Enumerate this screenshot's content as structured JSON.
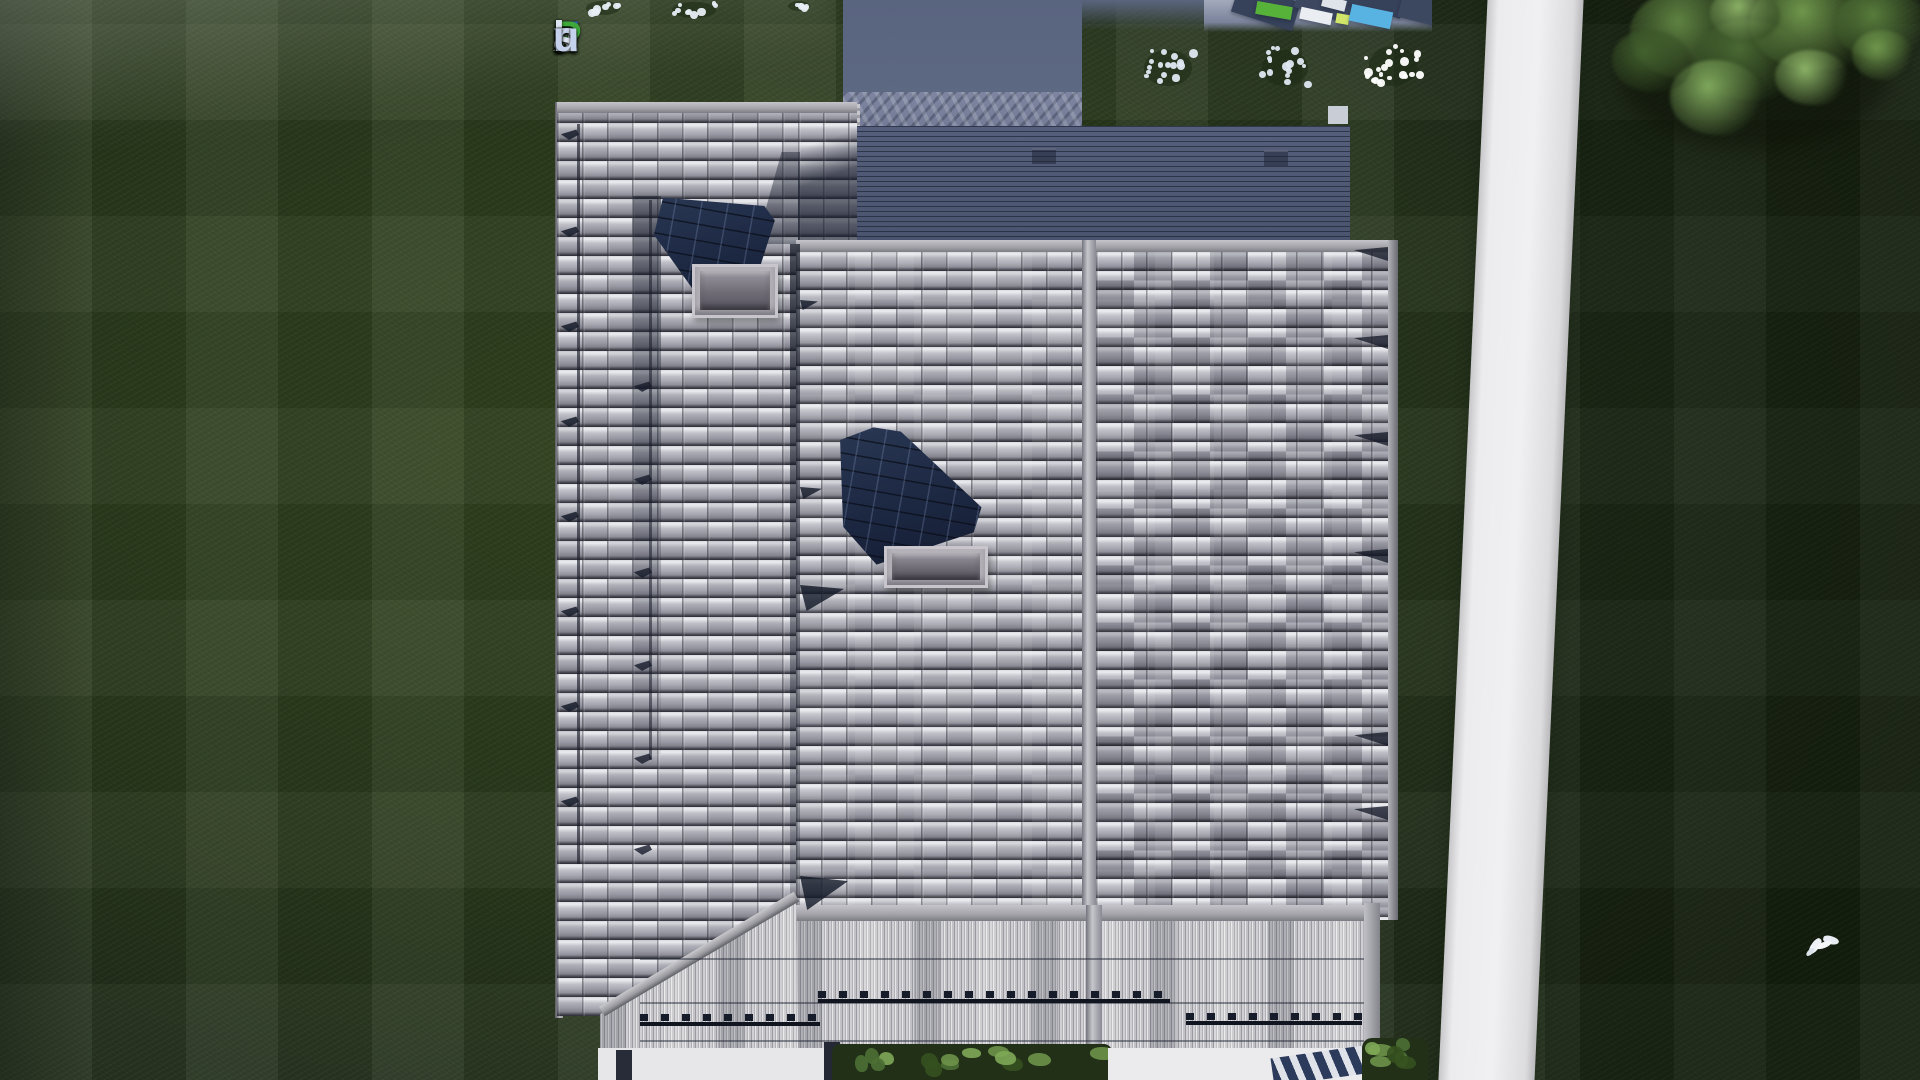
{
  "watermark": {
    "text": "FixPlans.ru",
    "letters": [
      {
        "ch": "F",
        "color": "#2f6cd8"
      },
      {
        "ch": "i",
        "color": "#dde4f2"
      },
      {
        "ch": "x",
        "color": "#dde4f2"
      },
      {
        "ch": "P",
        "color": "#3fa83a"
      },
      {
        "ch": "l",
        "color": "#dde4f2"
      },
      {
        "ch": "a",
        "color": "#dde4f2"
      },
      {
        "ch": "n",
        "color": "#dde4f2"
      },
      {
        "ch": "s",
        "color": "#dde4f2"
      },
      {
        "ch": ".",
        "color": "#2f6cd8"
      },
      {
        "ch": "r",
        "color": "#c6d2ec"
      },
      {
        "ch": "u",
        "color": "#c6d2ec"
      }
    ]
  },
  "scene": {
    "view": "aerial-top-down",
    "subject": "3D render of a house roof plan seen from directly above",
    "elements": {
      "roof_sections": [
        "left shingle wing",
        "center shingle wing",
        "right shingle wing",
        "dark flat terrace roof",
        "corrugated veranda roof"
      ],
      "roof_features": [
        "solar panel",
        "skylight box",
        "snow guard rails",
        "snow retention rows",
        "ridge beam",
        "hip fascia beam"
      ],
      "grounds": [
        "lawn with mowing stripes",
        "white garden path",
        "paver terrace",
        "white flower bushes",
        "tree canopy",
        "white bird",
        "driveway",
        "hedge shrubs",
        "striped doormat"
      ]
    },
    "palette": {
      "lawn": "#2a3a1c",
      "lawn_dark": "#1d2a14",
      "shingle_light": "#c9c9cf",
      "shingle_mid": "#a8a8b0",
      "shingle_dark": "#6e6e78",
      "flat_roof": "#4e5873",
      "solar_panel": "#202c46",
      "path": "#e8e8ea",
      "corrugated": "#b6b6ba",
      "tree_leaf": "#7fa85c",
      "flower": "#f2f5f8"
    }
  }
}
